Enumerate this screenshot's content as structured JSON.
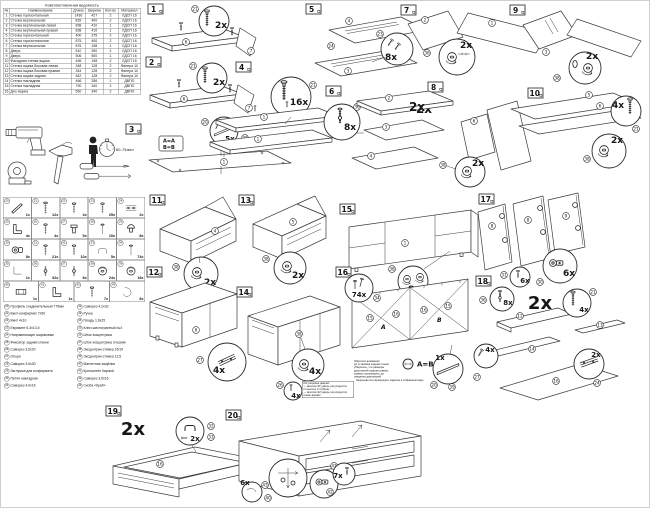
{
  "parts_table": {
    "title": "Комплектовочная ведомость",
    "headers": {
      "num": "№",
      "name": "Наименование",
      "len": "Длина",
      "wid": "Ширина",
      "qty": "Кол-во",
      "mat": "Материал"
    },
    "rows": [
      {
        "num": "1",
        "name": "Стенка горизонтальная",
        "len": "1436",
        "wid": "427",
        "qty": "2",
        "mat": "ЛДСП 16"
      },
      {
        "num": "2",
        "name": "Стенка вертикальная",
        "len": "839",
        "wid": "400",
        "qty": "2",
        "mat": "ЛДСП 16"
      },
      {
        "num": "3",
        "name": "Стенка вертикальная левая",
        "len": "838",
        "wid": "410",
        "qty": "1",
        "mat": "ЛДСП 16"
      },
      {
        "num": "4",
        "name": "Стенка вертикальная правая",
        "len": "838",
        "wid": "410",
        "qty": "1",
        "mat": "ЛДСП 16"
      },
      {
        "num": "5",
        "name": "Стенка горизонтальная",
        "len": "400",
        "wid": "375",
        "qty": "2",
        "mat": "ЛДСП 16"
      },
      {
        "num": "6",
        "name": "Стенка горизонтальная",
        "len": "875",
        "wid": "400",
        "qty": "2",
        "mat": "ЛДСП 16"
      },
      {
        "num": "7",
        "name": "Стенка вертикальная",
        "len": "876",
        "wid": "198",
        "qty": "1",
        "mat": "ЛДСП 16"
      },
      {
        "num": "8",
        "name": "Дверь",
        "len": "510",
        "wid": "390",
        "qty": "2",
        "mat": "ЛДСП 16"
      },
      {
        "num": "9",
        "name": "Дверь",
        "len": "506",
        "wid": "500",
        "qty": "1",
        "mat": "ЛДСП 16"
      },
      {
        "num": "10",
        "name": "Фасадная стенка ящика",
        "len": "496",
        "wid": "198",
        "qty": "2",
        "mat": "ЛДСП 16"
      },
      {
        "num": "11",
        "name": "Стенка ящика боковая левая",
        "len": "348",
        "wid": "128",
        "qty": "2",
        "mat": "Фанера 10"
      },
      {
        "num": "12",
        "name": "Стенка ящика боковая правая",
        "len": "344",
        "wid": "128",
        "qty": "2",
        "mat": "Фанера 10"
      },
      {
        "num": "13",
        "name": "Стенка ящика задняя",
        "len": "542",
        "wid": "128",
        "qty": "2",
        "mat": "Фанера 10"
      },
      {
        "num": "14",
        "name": "Стенка накладная",
        "len": "466",
        "wid": "286",
        "qty": "1",
        "mat": "ДВПО"
      },
      {
        "num": "15",
        "name": "Стенка накладная",
        "len": "790",
        "wid": "340",
        "qty": "2",
        "mat": "ДВПО"
      },
      {
        "num": "16",
        "name": "Дно ящика",
        "len": "550",
        "wid": "340",
        "qty": "2",
        "mat": "ДВПО"
      }
    ]
  },
  "tools": {
    "time": "60-75мин"
  },
  "hw_grid": {
    "items": [
      {
        "n": "20",
        "qty": "1x",
        "icon": "#i-profile"
      },
      {
        "n": "21",
        "qty": "12x",
        "icon": "#i-conf"
      },
      {
        "n": "22",
        "qty": "4x",
        "icon": "#i-screw"
      },
      {
        "n": "23",
        "qty": "25x",
        "icon": "#i-screw"
      },
      {
        "n": "24",
        "qty": "2x",
        "icon": "#i-rail"
      },
      {
        "n": "25",
        "qty": "4x",
        "icon": "#i-bracket"
      },
      {
        "n": "26",
        "qty": "4x",
        "icon": "#i-screw"
      },
      {
        "n": "27",
        "qty": "5x",
        "icon": "#i-foot"
      },
      {
        "n": "28",
        "qty": "10x",
        "icon": "#i-nail"
      },
      {
        "n": "29",
        "qty": "8x",
        "icon": "#i-plug"
      },
      {
        "n": "30",
        "qty": "8x",
        "icon": "#i-hinge"
      },
      {
        "n": "31",
        "qty": "21x",
        "icon": "#i-screw"
      },
      {
        "n": "32",
        "qty": "10x",
        "icon": "#i-screw"
      },
      {
        "n": "33",
        "qty": "5x",
        "icon": "#i-handle"
      },
      {
        "n": "34",
        "qty": "74x",
        "icon": "#i-nail"
      },
      {
        "n": "35",
        "qty": "1x",
        "icon": "#i-key"
      },
      {
        "n": "36",
        "qty": "32x",
        "icon": "#i-shaft"
      },
      {
        "n": "37",
        "qty": "8x",
        "icon": "#i-shaft"
      },
      {
        "n": "38",
        "qty": "24x",
        "icon": "#i-cam"
      },
      {
        "n": "39",
        "qty": "16x",
        "icon": "#i-cam"
      }
    ],
    "items2": [
      {
        "n": "40",
        "qty": "1x",
        "icon": "#i-magnet"
      },
      {
        "n": "41",
        "qty": "1x",
        "icon": "#i-bracket"
      },
      {
        "n": "42",
        "qty": "7x",
        "icon": "#i-screw"
      },
      {
        "n": "43",
        "qty": "6x",
        "icon": "#i-clip"
      }
    ]
  },
  "hw_list": {
    "left": [
      {
        "n": "20",
        "text": "Профиль соединительный 775мм"
      },
      {
        "n": "21",
        "text": "Винт-конфирмат 7х50"
      },
      {
        "n": "22",
        "text": "Винт 4х10"
      },
      {
        "n": "23",
        "text": "Евровинт 6,3х13,5"
      },
      {
        "n": "24",
        "text": "Направляющие шариковые"
      },
      {
        "n": "25",
        "text": "Фиксатор задней стенки"
      },
      {
        "n": "26",
        "text": "Саморез 3,5х20"
      },
      {
        "n": "27",
        "text": "Опора"
      },
      {
        "n": "28",
        "text": "Саморез 3,5х30"
      },
      {
        "n": "29",
        "text": "Заглушка для конфирмата"
      },
      {
        "n": "30",
        "text": "Петля накладная"
      },
      {
        "n": "31",
        "text": "Саморез 4,0х16"
      }
    ],
    "right": [
      {
        "n": "32",
        "text": "Саморез 4,2х32"
      },
      {
        "n": "33",
        "text": "Ручка"
      },
      {
        "n": "34",
        "text": "Гвоздь 1,6х25"
      },
      {
        "n": "35",
        "text": "Ключ шестигранный №4"
      },
      {
        "n": "36",
        "text": "Шток эксцентрика"
      },
      {
        "n": "37",
        "text": "Шток эксцентрика плоский"
      },
      {
        "n": "38",
        "text": "Эксцентрик-стяжка 15/19"
      },
      {
        "n": "39",
        "text": "Эксцентрик-стяжка 12,5"
      },
      {
        "n": "40",
        "text": "Магнитная защёлка"
      },
      {
        "n": "41",
        "text": "Кронштейн барный"
      },
      {
        "n": "42",
        "text": "Саморез 3,5х16"
      },
      {
        "n": "43",
        "text": "Скоба «Краб»"
      }
    ]
  },
  "steps": {
    "s1": {
      "n": "1",
      "q1": "2x",
      "p1": "21",
      "b1": "6",
      "b2": "7"
    },
    "s2": {
      "n": "2",
      "q1": "2x",
      "p1": "21",
      "b1": "6",
      "b2": "7"
    },
    "s3": {
      "n": "3",
      "abA": "A=A",
      "abB": "B=B",
      "q1": "5x",
      "p1": "22",
      "p2": "20",
      "b1": "1"
    },
    "s4": {
      "n": "4",
      "q1": "16x",
      "p1": "21",
      "b1": "1",
      "b2": "1"
    },
    "s5": {
      "n": "5",
      "q1": "8x",
      "p1": "23",
      "b1": "4",
      "b2": "24",
      "b3": "3"
    },
    "s6": {
      "n": "6",
      "big": "2x",
      "q1": "8x",
      "p1": "36",
      "b1": "2",
      "b2": "3",
      "b3": "4"
    },
    "s7": {
      "n": "7",
      "q1": "2x",
      "p1": "36",
      "b1": "2",
      "b2": "1"
    },
    "s8": {
      "n": "8",
      "big": "2x",
      "q1": "2x",
      "p1": "38",
      "b1": "2",
      "b2": "6"
    },
    "s9": {
      "n": "9",
      "q1": "2x",
      "p1": "38",
      "b1": "3"
    },
    "s10": {
      "n": "10",
      "q1": "4x",
      "p1": "21",
      "q2": "2x",
      "p2": "38",
      "b1": "5",
      "b2": "6"
    },
    "s11": {
      "n": "11",
      "q1": "2x",
      "p1": "38",
      "b1": "4"
    },
    "s12": {
      "n": "12",
      "q1": "4x",
      "p1": "27",
      "b1": "6"
    },
    "s13": {
      "n": "13",
      "q1": "2x",
      "p1": "38",
      "b1": "5"
    },
    "s14": {
      "n": "14",
      "q1": "4x",
      "p1": "38"
    },
    "s15": {
      "n": "15",
      "q1": "8x",
      "p1": "38",
      "b1": "1"
    },
    "s16": {
      "n": "16",
      "q1": "74x",
      "p1": "34",
      "q2": "1x",
      "p2": "20",
      "p3": "39",
      "b1": "15",
      "b2": "16",
      "b3": "16",
      "b4": "15",
      "a": "A",
      "b": "B",
      "ab": "A=B"
    },
    "s17": {
      "n": "17",
      "q1": "6x",
      "p1": "31",
      "q2": "6x",
      "p2": "30",
      "b1": "8",
      "b2": "8",
      "b3": "9"
    },
    "s18": {
      "n": "18",
      "big": "2x",
      "q1": "8x",
      "p1": "36",
      "q2": "4x",
      "p2": "21",
      "q3": "4x",
      "p3": "27",
      "q4": "2x",
      "p4": "24",
      "b1": "12",
      "b2": "13",
      "b3": "14",
      "b4": "16"
    },
    "s19": {
      "n": "19",
      "big": "2x",
      "q1": "2x",
      "p1": "32",
      "p2": "33",
      "b1": "16"
    },
    "s20": {
      "n": "20",
      "q1": "7x",
      "p1": "42",
      "q2": "6x",
      "p2": "43",
      "q3": "4x",
      "p3": "26",
      "b1": "41",
      "b2": "40"
    }
  },
  "notes": {
    "note16": "Обратите внимание!\nдо установки задней стенки\nубедитесь, что размеры\nдиагоналей изделия равны,\nзамеры производить до\nсведения диагоналей",
    "note20": "Регулировка дверей:\n— винтом (41) дверь регулируется\nпо высоте и глубине;\n— винтом (42) дверь регулируется\nвлево-вправо",
    "cap20": "Запрещается перемещать изделие в собранном виде"
  }
}
